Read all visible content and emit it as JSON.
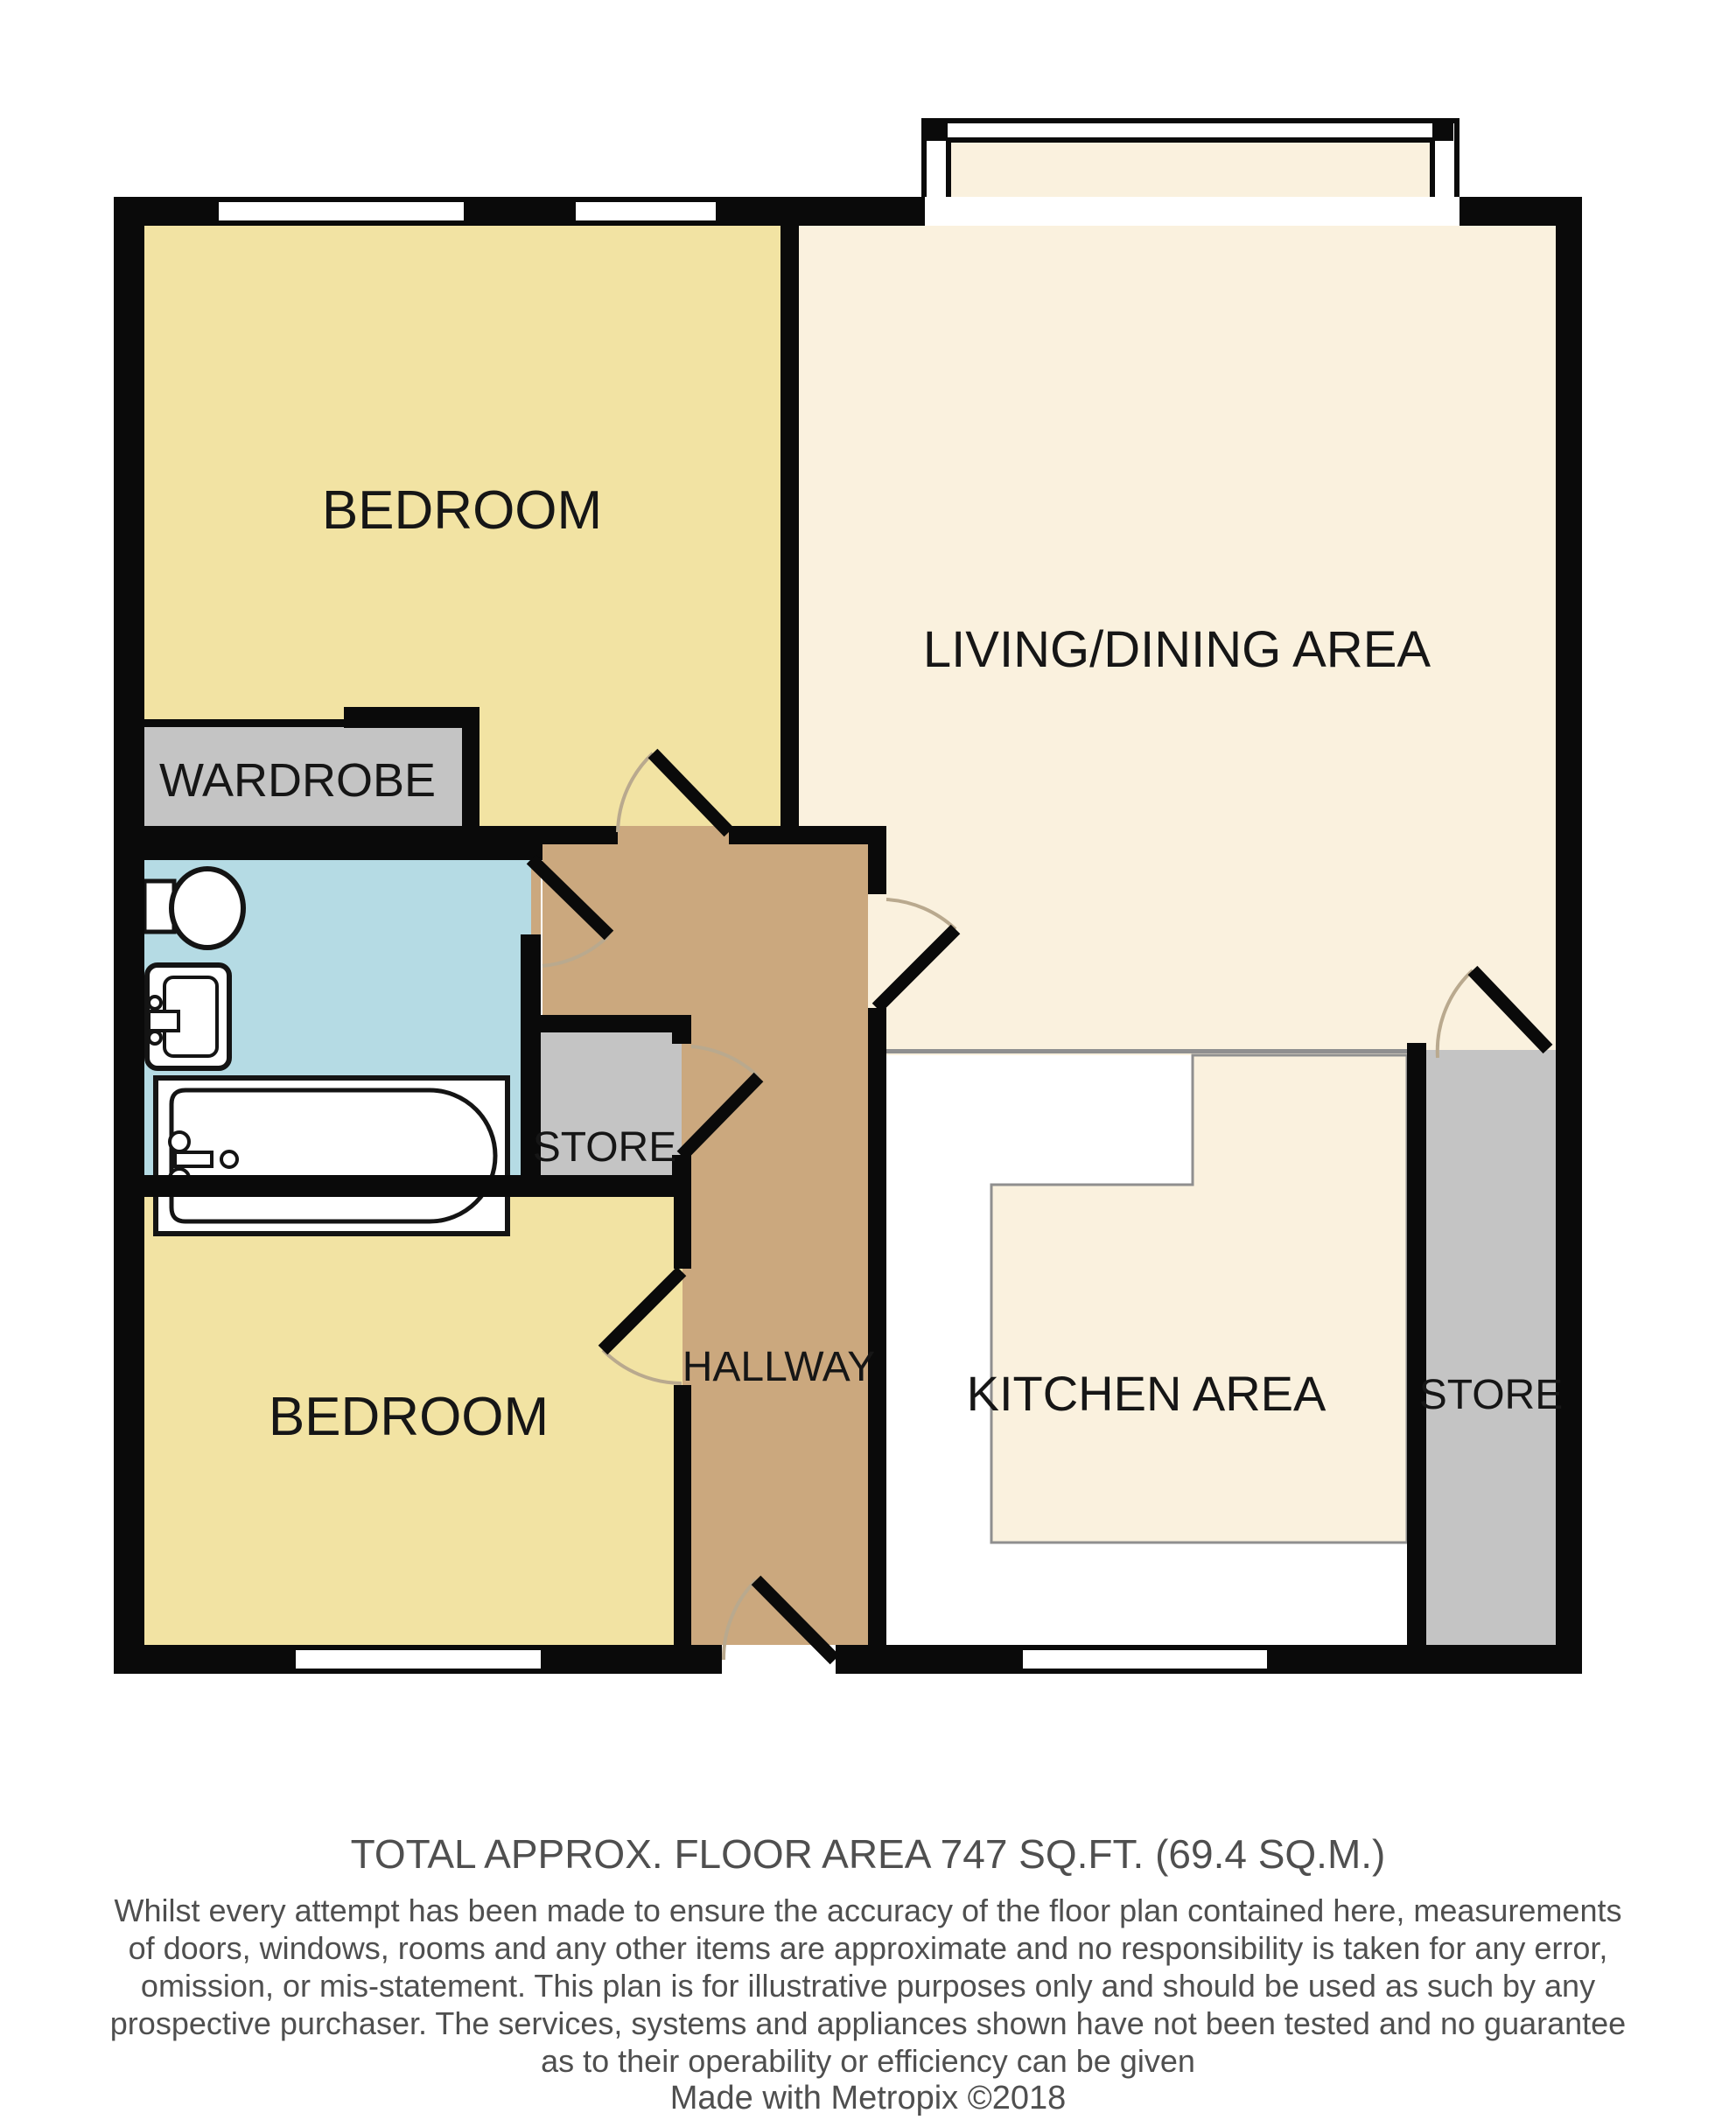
{
  "plan": {
    "colors": {
      "wall": "#0a0a0a",
      "bedroom": "#F2E3A3",
      "living_kitchen": "#FAF1DE",
      "hallway": "#CBA87E",
      "bathroom": "#B5DBE4",
      "store": "#C4C4C4",
      "counter": "#FFFFFF",
      "counter_outline": "#8F8F8F",
      "door_arc": "#B9A98E",
      "footer_text": "#4F4F4F"
    },
    "labels": {
      "bedroom_top": "BEDROOM",
      "living_dining": "LIVING/DINING AREA",
      "wardrobe": "WARDROBE",
      "store_middle": "STORE",
      "hallway": "HALLWAY",
      "kitchen": "KITCHEN AREA",
      "store_right": "STORE",
      "bedroom_bottom": "BEDROOM"
    }
  },
  "footer": {
    "title": "TOTAL APPROX. FLOOR AREA 747 SQ.FT. (69.4 SQ.M.)",
    "disclaimer_lines": [
      "Whilst every attempt has been made to ensure the accuracy of the floor plan contained here, measurements",
      "of doors, windows, rooms and any other items are approximate and no responsibility is taken for any error,",
      "omission, or mis-statement. This plan is for illustrative purposes only and should be used as such by any",
      "prospective purchaser. The services, systems and appliances shown have not been tested and no guarantee",
      "as to their operability or efficiency can be given"
    ],
    "credit": "Made with Metropix ©2018"
  }
}
